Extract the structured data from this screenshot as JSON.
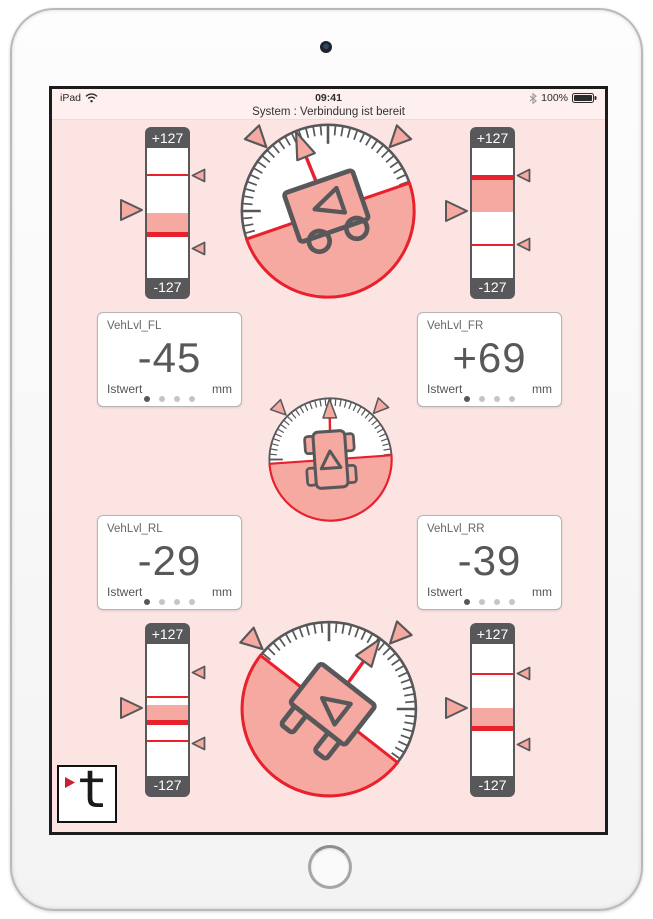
{
  "status_bar": {
    "left_text": "iPad",
    "time": "09:41",
    "battery_percent": "100%"
  },
  "system_message": "System : Verbindung ist bereit",
  "slider_scale": {
    "max_label": "+127",
    "min_label": "-127"
  },
  "tiles": {
    "fl": {
      "title": "VehLvl_FL",
      "value": "-45",
      "caption": "Istwert",
      "unit": "mm"
    },
    "fr": {
      "title": "VehLvl_FR",
      "value": "+69",
      "caption": "Istwert",
      "unit": "mm"
    },
    "rl": {
      "title": "VehLvl_RL",
      "value": "-29",
      "caption": "Istwert",
      "unit": "mm"
    },
    "rr": {
      "title": "VehLvl_RR",
      "value": "-39",
      "caption": "Istwert",
      "unit": "mm"
    }
  },
  "dots": {
    "count": 4,
    "active": 0
  },
  "sliders": {
    "fl": {
      "fill": [
        50,
        66.5
      ],
      "thick_line": 66.5,
      "thin_lines": [
        21
      ],
      "big_marker": 48,
      "small_markers": [
        21,
        77
      ]
    },
    "fr": {
      "fill": [
        22.7,
        49.2
      ],
      "thick_line": 22.7,
      "thin_lines": [
        74.5
      ],
      "big_marker": 48.5,
      "small_markers": [
        21.4,
        74.5
      ]
    },
    "rl": {
      "fill": [
        46.4,
        58
      ],
      "thick_line": 59.5,
      "thin_lines": [
        40,
        73.8
      ],
      "big_marker": 48.8,
      "small_markers": [
        21.4,
        75
      ]
    },
    "rr": {
      "fill": [
        48.8,
        62.5
      ],
      "thick_line": 63.8,
      "thin_lines": [
        22.6
      ],
      "big_marker": 48.8,
      "small_markers": [
        22.6,
        76.2
      ]
    }
  },
  "gauges": {
    "front": {
      "tilt_deg": -19,
      "needle_deg": -22,
      "car_view": "side",
      "marker_angles": [
        -44,
        44
      ]
    },
    "center": {
      "tilt_deg": -4,
      "needle_deg": -1,
      "car_view": "top",
      "marker_angles": [
        -45,
        43
      ]
    },
    "rear": {
      "tilt_deg": 38,
      "needle_deg": 36,
      "car_view": "front",
      "marker_angles": [
        -48,
        43
      ]
    }
  },
  "logo": {
    "letter": "t"
  },
  "colors": {
    "app_bg": "#fce4e2",
    "header_bg": "#fdf0ef",
    "pink": "#f5a9a1",
    "red": "#e8212d",
    "dark": "#58585a"
  }
}
